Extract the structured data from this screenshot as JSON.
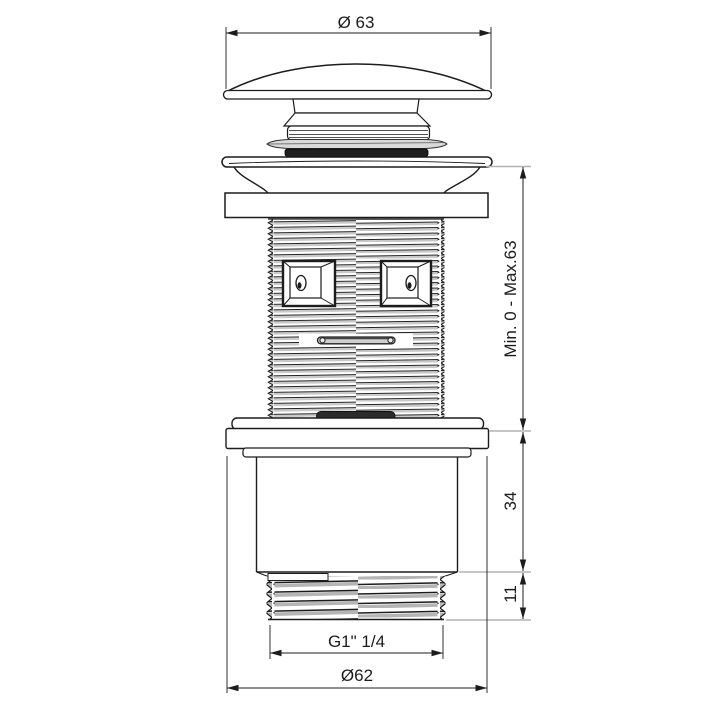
{
  "drawing": {
    "background": "#ffffff",
    "line_color": "#1c1c1c",
    "extension_line_color": "#b3b3b3",
    "dimensions": {
      "top_cap_diameter": "Ø 63",
      "adjustable_height_range": "Min. 0 - Max.63",
      "body_height": "34",
      "outlet_thread_length": "11",
      "outlet_thread_spec": "G1\" 1/4",
      "flange_nut_diameter": "Ø62"
    }
  }
}
